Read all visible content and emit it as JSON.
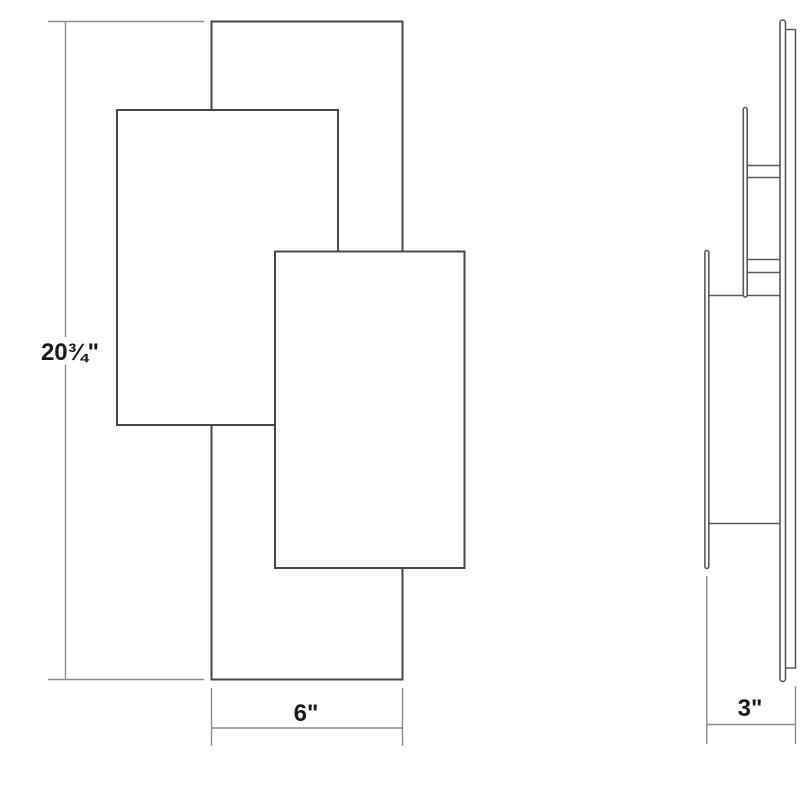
{
  "drawing": {
    "kind": "technical dimension drawing, two orthographic views of a layered rectangular wall sconce",
    "front_view": {
      "panels": [
        "back tall panel",
        "upper-left panel",
        "center-right front panel"
      ],
      "height_dimension": "20¾\"",
      "width_dimension": "6\""
    },
    "side_view": {
      "elements": [
        "front plate edge",
        "middle plate edge",
        "back plate with wall return",
        "two standoff connectors"
      ],
      "depth_dimension": "3\""
    },
    "colors": {
      "background": "#ffffff",
      "front_outline": "#474747",
      "side_outline": "#5a5a5a",
      "dimension_line": "#8c8c8c",
      "label_text": "#1a1a1a"
    }
  }
}
